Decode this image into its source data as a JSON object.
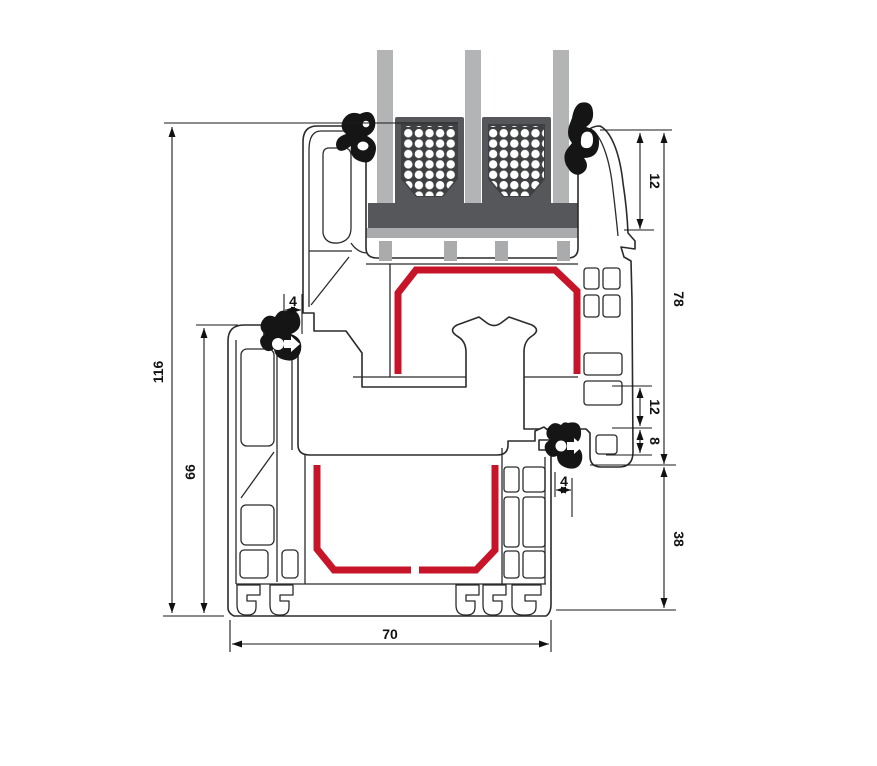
{
  "diagram": {
    "kind": "window-profile-cross-section"
  },
  "dimensions": {
    "overall_height": "116",
    "frame_height": "66",
    "gasket_left": "4",
    "glazing_inset": "12",
    "sash_section_height": "78",
    "rebate_gap": "12",
    "seal_overlap": "8",
    "gasket_right": "4",
    "frame_face_height": "38",
    "frame_depth": "70"
  },
  "colors": {
    "steel_reinforcement": "#c81428",
    "glass_pane": "#b2b4b6",
    "spacer_block_frame": "#55575a",
    "spacer_block_inner": "#3e4042",
    "setting_block": "#55575a",
    "glazing_bridge": "#a9abad",
    "gasket": "#151515",
    "profile_outline": "#2b2b2b",
    "profile_fill": "#ffffff",
    "dimension_line": "#1a1a1a",
    "background": "#ffffff"
  }
}
